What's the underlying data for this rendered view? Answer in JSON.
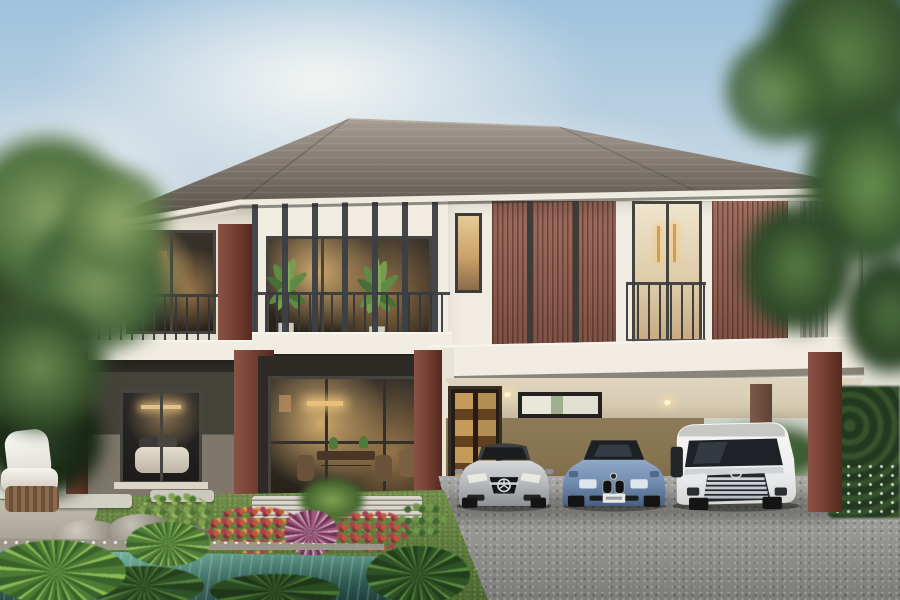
{
  "meta": {
    "domain": "natural-image",
    "description": "Photorealistic exterior rendering of a modern two-storey luxury house: hip roof, cream walls with terracotta timber-slat facade, maroon columns, balconies with dark metal fins and railings, warm-lit interiors, carport with three parked cars (silver sedan, blue sedan, white minivan), gravel driveway, lawn with flower beds, rocks, swimming pool, wicker armchair and surrounding trees."
  },
  "scene": {
    "objects": [
      "hip-roof",
      "left-balcony",
      "center-balcony-with-fins",
      "timber-slat-facade",
      "juliet-balcony-door",
      "narrow-stair-window",
      "maroon-columns",
      "bedroom-glass-door",
      "living-room-glass-wall",
      "carport",
      "display-cabinet",
      "slit-window",
      "silver-sedan",
      "blue-sedan",
      "white-minivan",
      "gravel-driveway",
      "lawn",
      "stepping-stones",
      "flower-bed",
      "rock-cluster",
      "swimming-pool",
      "wicker-armchair",
      "boxwood-hedge",
      "left-tree",
      "right-tree",
      "clouds"
    ],
    "vehicles": [
      {
        "id": "silver-sedan",
        "emblem": "three-pointed-star",
        "color": "#b6b9bb"
      },
      {
        "id": "blue-sedan",
        "emblem": "roundel",
        "color": "#6f8cb0"
      },
      {
        "id": "white-minivan",
        "emblem": "oval",
        "color": "#f2f2f0"
      }
    ]
  },
  "palette": {
    "sky_top": "#9fc2dd",
    "sky_mid": "#c6d7e3",
    "sky_low": "#e3e3da",
    "roof_light": "#a0988f",
    "roof_dark": "#4f4a43",
    "fascia": "#efeade",
    "wall_cream": "#e6e0d3",
    "wall_white": "#f0ece2",
    "wood": "#8f5f52",
    "maroon": "#7a4336",
    "band": "#f1ece1",
    "soffit_dark": "#37342e",
    "wall_ground": "#45423a",
    "wall_ground_light": "#7e776a",
    "carport_wall": "#85724f",
    "ceiling": "#d6cab1",
    "drive_light": "#9f9f9c",
    "drive_dark": "#7b7b78",
    "grass_light": "#74914c",
    "grass_dark": "#4c6a33",
    "pool_light": "#67a493",
    "pool_dark": "#2f5b52",
    "stone": "#cfccc2",
    "hedge": "#2c4226",
    "tree_light": "#7f9a5e",
    "tree_dark": "#3a5530",
    "glow": "#e2b377",
    "car_silver": "#b6b9bb",
    "car_blue": "#6f8cb0",
    "car_white": "#f2f2f0"
  }
}
